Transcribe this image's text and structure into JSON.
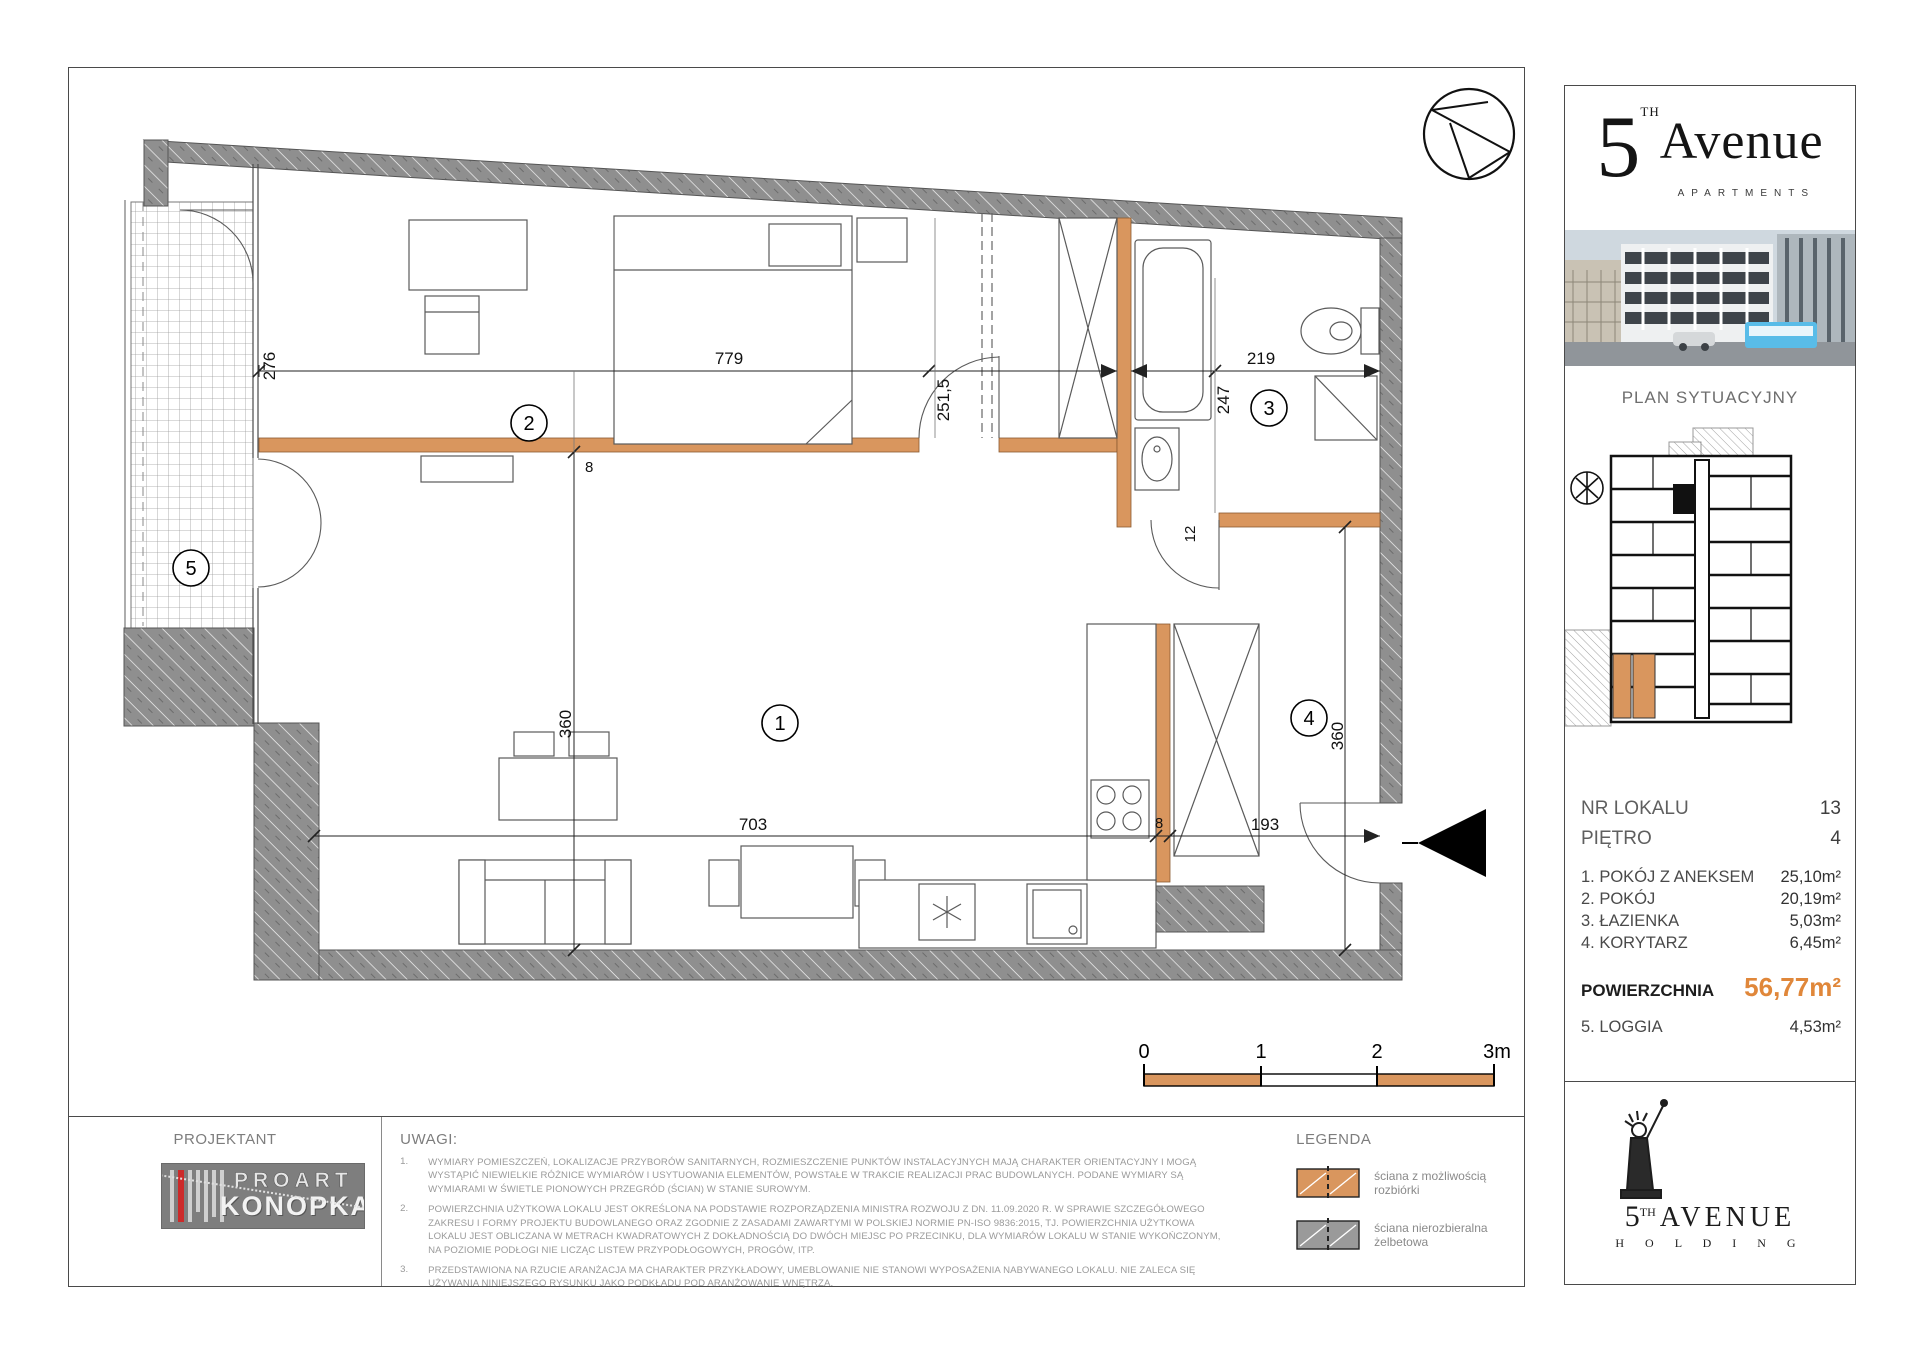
{
  "plan": {
    "rooms": [
      "1",
      "2",
      "3",
      "4",
      "5"
    ],
    "dims": {
      "left_w": "276",
      "top_w": "779",
      "mid_h": "251,5",
      "bath_h": "247",
      "bath_w": "219",
      "wall_a": "8",
      "wall_b": "12",
      "left_h": "360",
      "right_h": "360",
      "bottom_w": "703",
      "kitchen_wall": "8",
      "entry_w": "193"
    },
    "scale": {
      "t0": "0",
      "t1": "1",
      "t2": "2",
      "t3": "3m"
    }
  },
  "sidebar": {
    "brand": {
      "five": "5",
      "sup": "TH",
      "name": "Avenue",
      "subtitle": "APARTMENTS"
    },
    "siteplan_title": "PLAN SYTUACYJNY",
    "fields": [
      {
        "label": "NR LOKALU",
        "value": "13"
      },
      {
        "label": "PIĘTRO",
        "value": "4"
      }
    ],
    "rooms": [
      {
        "name": "1. POKÓJ Z ANEKSEM",
        "area": "25,10m²"
      },
      {
        "name": "2. POKÓJ",
        "area": "20,19m²"
      },
      {
        "name": "3. ŁAZIENKA",
        "area": "5,03m²"
      },
      {
        "name": "4. KORYTARZ",
        "area": "6,45m²"
      }
    ],
    "total": {
      "label": "POWIERZCHNIA",
      "value": "56,77m²"
    },
    "loggia": {
      "name": "5. LOGGIA",
      "area": "4,53m²"
    }
  },
  "footer": {
    "projektant": {
      "title": "PROJEKTANT",
      "logo_line1": "PROART",
      "logo_line2": "KONOPKA"
    },
    "uwagi": {
      "title": "UWAGI:",
      "notes": [
        {
          "num": "1.",
          "text": "WYMIARY POMIESZCZEŃ, LOKALIZACJE PRZYBORÓW SANITARNYCH, ROZMIESZCZENIE PUNKTÓW INSTALACYJNYCH MAJĄ CHARAKTER ORIENTACYJNY I MOGĄ WYSTĄPIĆ NIEWIELKIE RÓŻNICE WYMIARÓW I USYTUOWANIA ELEMENTÓW, POWSTAŁE W TRAKCIE REALIZACJI PRAC BUDOWLANYCH. PODANE WYMIARY SĄ WYMIARAMI W ŚWIETLE PIONOWYCH PRZEGRÓD (ŚCIAN) W STANIE SUROWYM."
        },
        {
          "num": "2.",
          "text": "POWIERZCHNIA UŻYTKOWA LOKALU JEST OKREŚLONA NA PODSTAWIE ROZPORZĄDZENIA MINISTRA ROZWOJU Z DN. 11.09.2020 R. W SPRAWIE SZCZEGÓŁOWEGO ZAKRESU I FORMY PROJEKTU BUDOWLANEGO ORAZ ZGODNIE Z ZASADAMI ZAWARTYMI W POLSKIEJ NORMIE PN-ISO 9836:2015, TJ. POWIERZCHNIA UŻYTKOWA LOKALU JEST OBLICZANA W METRACH KWADRATOWYCH Z DOKŁADNOŚCIĄ DO DWÓCH MIEJSC PO PRZECINKU, DLA WYMIARÓW LOKALU W STANIE WYKOŃCZONYM, NA POZIOMIE PODŁOGI NIE LICZĄC LISTEW PRZYPODŁOGOWYCH, PROGÓW, ITP."
        },
        {
          "num": "3.",
          "text": "PRZEDSTAWIONA NA RZUCIE ARANŻACJA MA CHARAKTER PRZYKŁADOWY, UMEBLOWANIE NIE STANOWI WYPOSAŻENIA NABYWANEGO LOKALU. NIE ZALECA SIĘ UŻYWANIA NINIEJSZEGO RYSUNKU JAKO PODKŁADU POD ARANŻOWANIE WNĘTRZA."
        }
      ]
    },
    "legenda": {
      "title": "LEGENDA",
      "items": [
        {
          "label": "ściana z możliwością rozbiórki",
          "color": "#D9965E"
        },
        {
          "label": "ściana nierozbieralna żelbetowa",
          "color": "#9A9A9A"
        }
      ]
    },
    "holding": {
      "five": "5",
      "sup": "TH",
      "name": "AVENUE",
      "subtitle": "H O L D I N G"
    }
  },
  "colors": {
    "wall_orange": "#D9965E",
    "wall_gray": "#8F8F8F",
    "accent_orange": "#E0873A"
  }
}
